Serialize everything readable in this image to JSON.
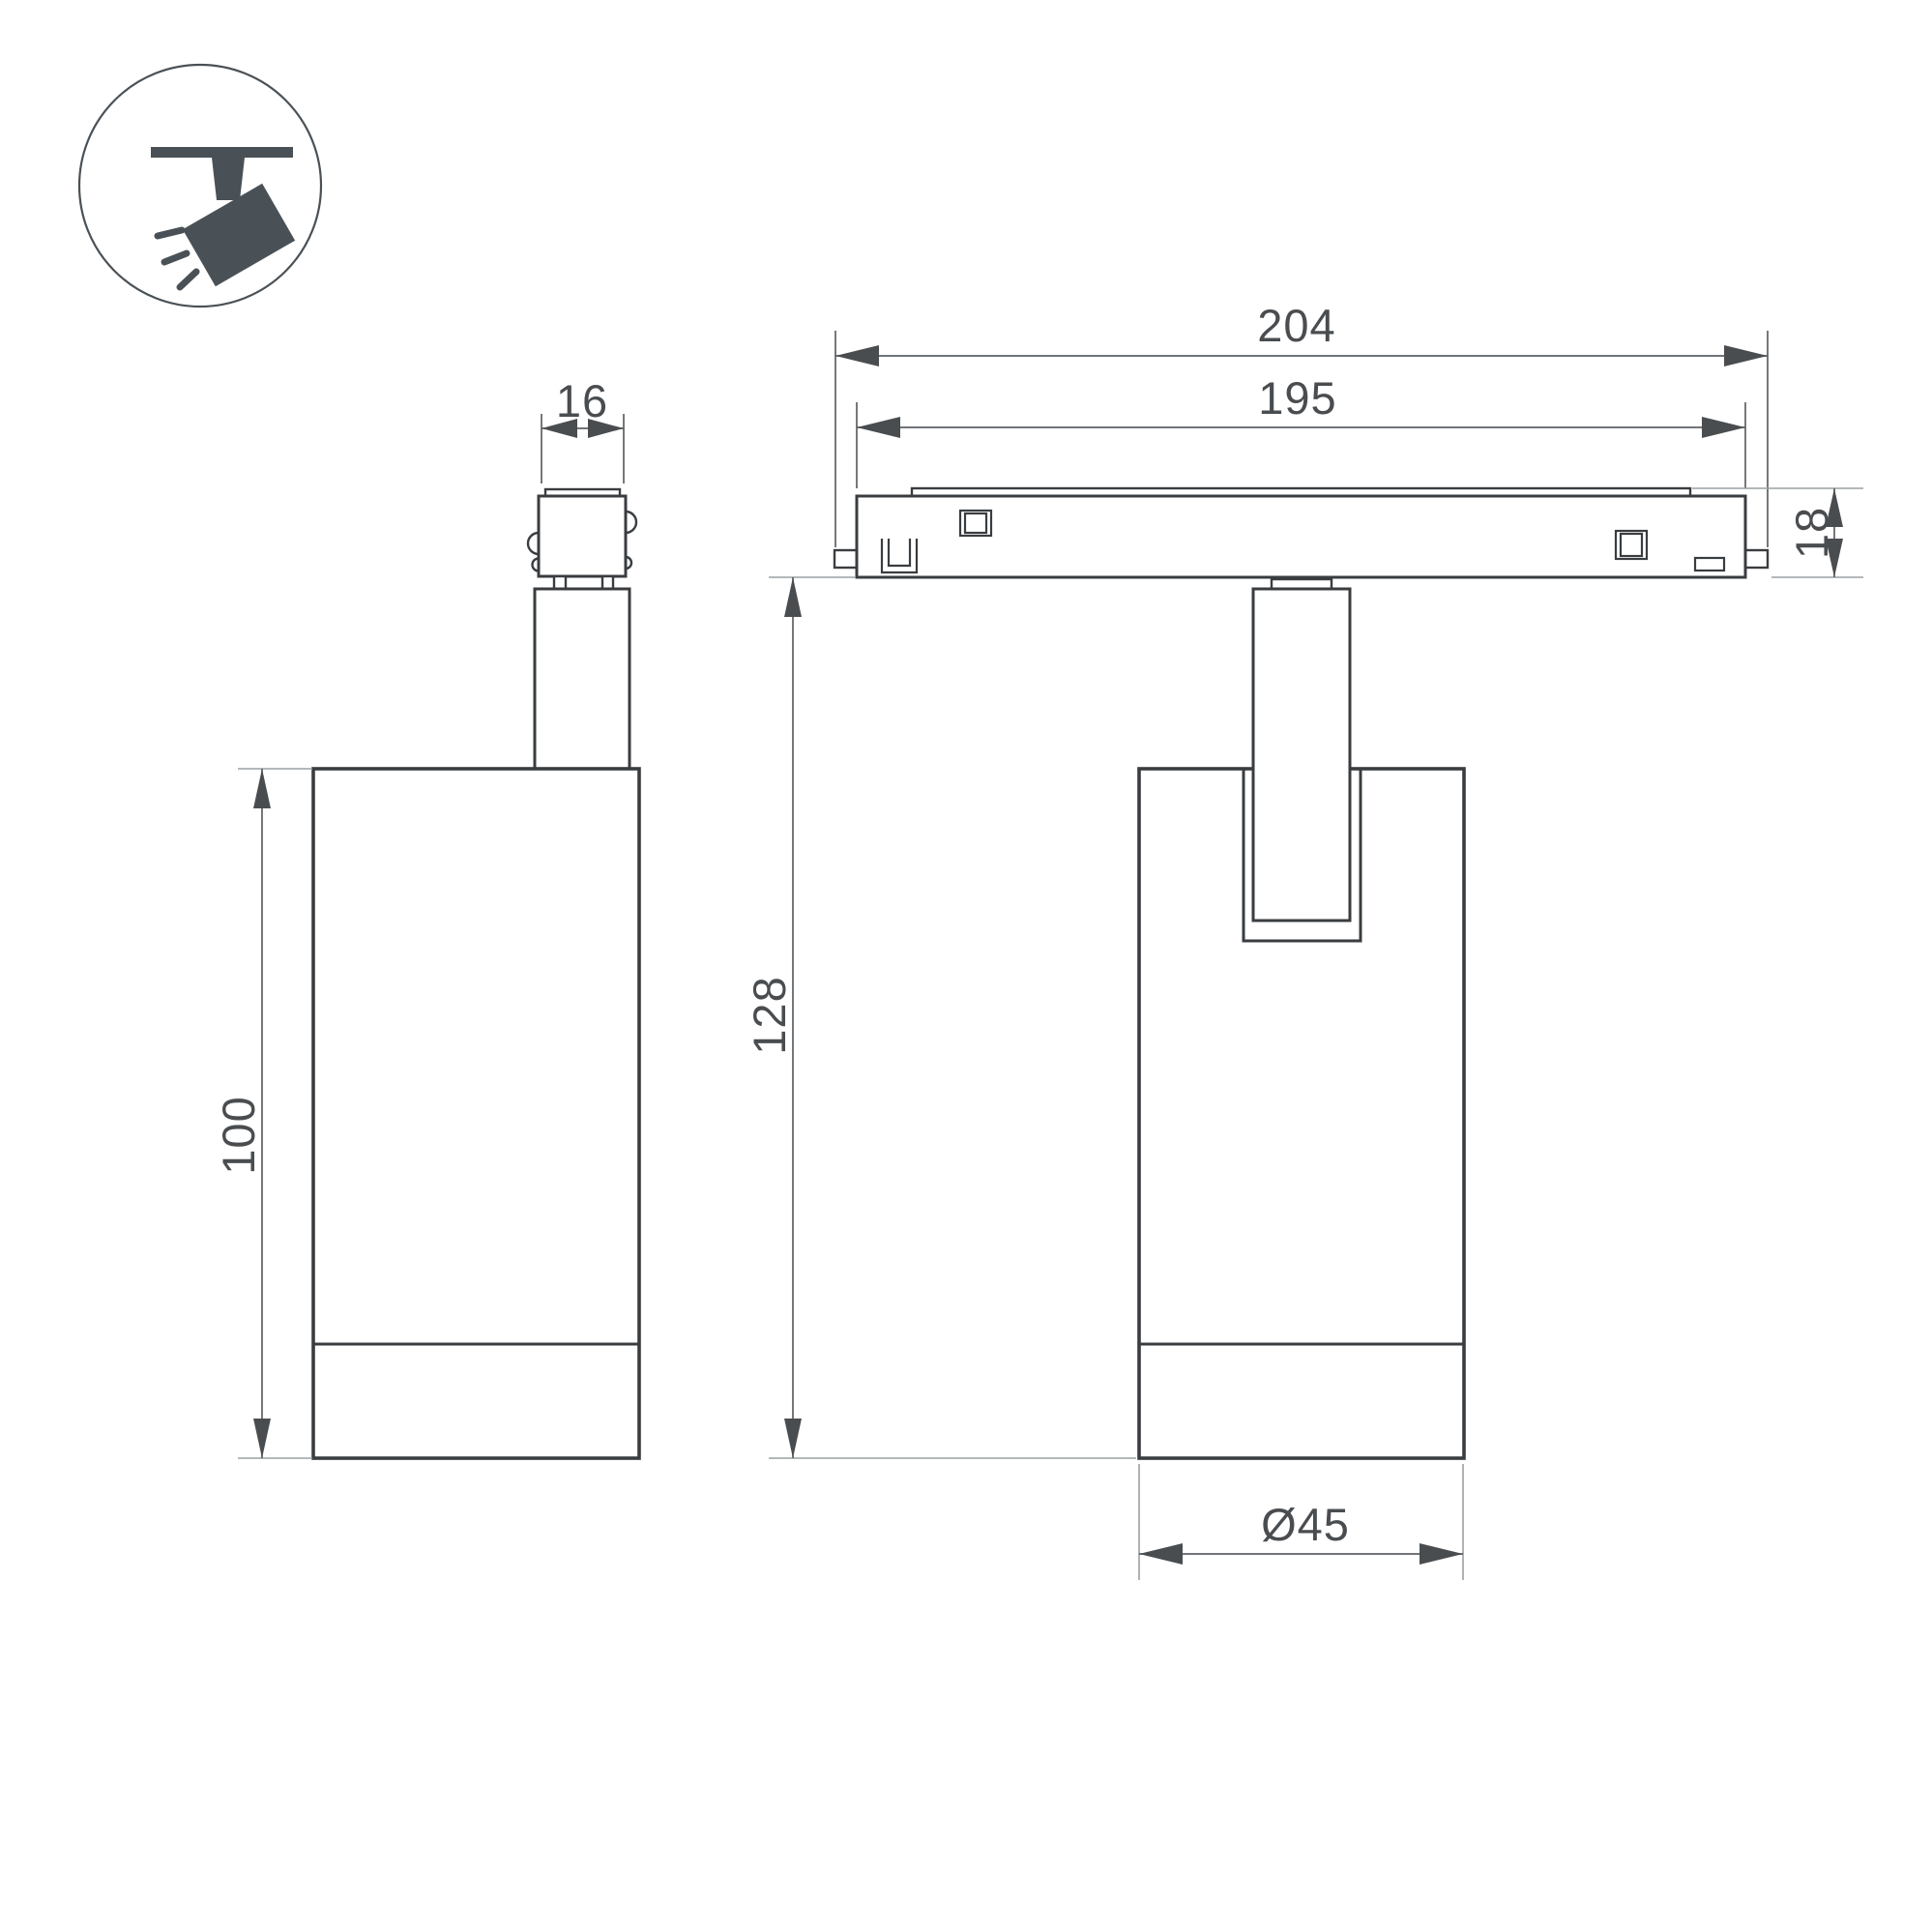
{
  "page": {
    "background": "#ffffff"
  },
  "icon": {
    "name": "ceiling-track-spotlight",
    "color": "#4a5156"
  },
  "colors": {
    "outline": "#3a3d40",
    "dimension_line": "#5d6164",
    "extension_line": "#9aa0a3",
    "dimension_text": "#4a4d50"
  },
  "views": {
    "side_view": {
      "dimensions": {
        "connector_width": "16",
        "body_height": "100"
      }
    },
    "front_view": {
      "dimensions": {
        "track_length_outer": "204",
        "track_length_inner": "195",
        "track_height": "18",
        "overall_height": "128",
        "body_diameter": "Ø45"
      }
    }
  }
}
